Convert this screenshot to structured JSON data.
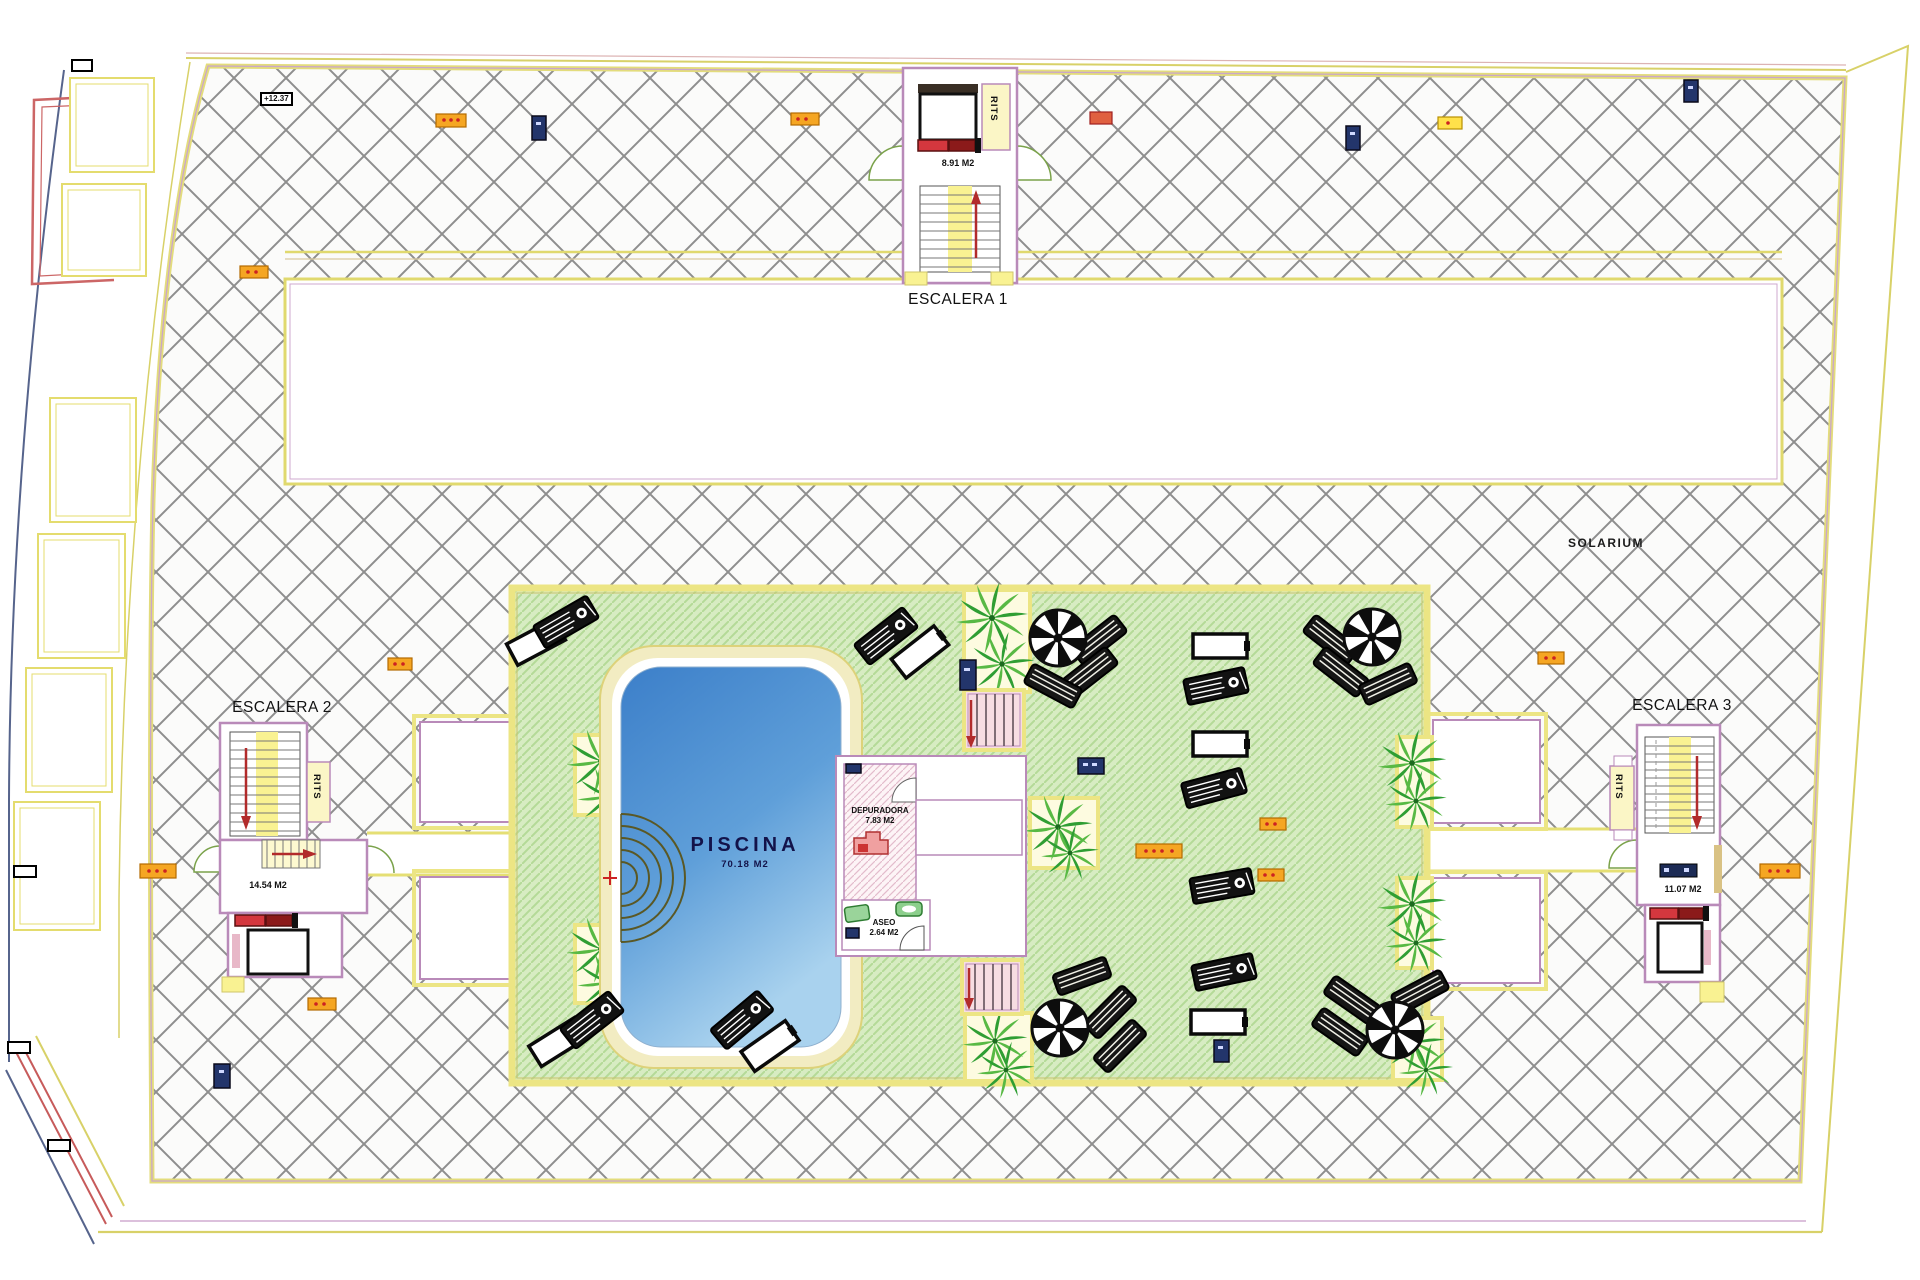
{
  "drawing": {
    "labels": {
      "solarium": "SOLARIUM",
      "level_marker": "+12.37"
    },
    "stairs": [
      {
        "label": "ESCALERA 1",
        "area": "8.91 M2",
        "shaft": "RITS"
      },
      {
        "label": "ESCALERA 2",
        "area": "14.54 M2",
        "shaft": "RITS"
      },
      {
        "label": "ESCALERA 3",
        "area": "11.07 M2",
        "shaft": "RITS"
      }
    ],
    "pool": {
      "label": "PISCINA",
      "area": "70.18 M2"
    },
    "rooms": [
      {
        "label": "DEPURADORA",
        "area": "7.83 M2"
      },
      {
        "label": "ASEO",
        "area": "2.64 M2"
      }
    ],
    "colors": {
      "deck_hatch_line": "#8e8e8e",
      "lawn_green": "#d7ecc2",
      "lawn_stripe": "#b4da97",
      "pool_blue_dark": "#3c7fc9",
      "pool_blue_light": "#a9d2ee",
      "border_yellow": "#ece584",
      "wall_plum": "#b98ab9",
      "marker_orange": "#f5a623",
      "marker_navy": "#23356b",
      "arrow_red": "#b22b2b"
    }
  }
}
